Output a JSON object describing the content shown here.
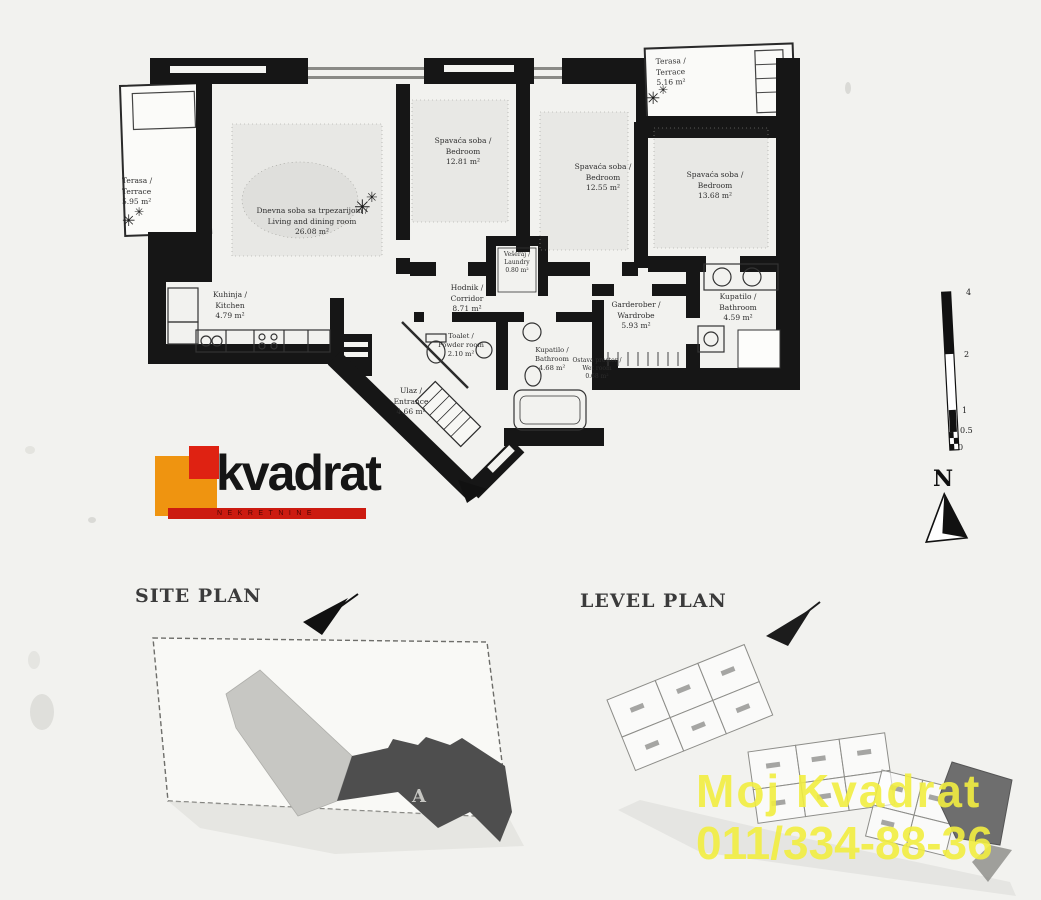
{
  "page": {
    "background_color": "#f2f2ef"
  },
  "logo": {
    "name": "kvadrat",
    "subtitle": "NEKRETNINE",
    "orange_color": "#ef9410",
    "red_color": "#df2212",
    "bar_color": "#cc1b10"
  },
  "floor_plan": {
    "north_label": "N",
    "rooms": [
      {
        "id": "terrace-left",
        "line1": "Terasa /",
        "line2": "Terrace",
        "line3": "5.95 m²"
      },
      {
        "id": "living-dining",
        "line1": "Dnevna soba sa trpezarijom /",
        "line2": "Living and dining room",
        "line3": "26.08 m²"
      },
      {
        "id": "bedroom-1",
        "line1": "Spavaća soba /",
        "line2": "Bedroom",
        "line3": "12.81 m²"
      },
      {
        "id": "bedroom-2",
        "line1": "Spavaća soba /",
        "line2": "Bedroom",
        "line3": "12.55 m²"
      },
      {
        "id": "bedroom-3",
        "line1": "Spavaća soba /",
        "line2": "Bedroom",
        "line3": "13.68 m²"
      },
      {
        "id": "terrace-top",
        "line1": "Terasa /",
        "line2": "Terrace",
        "line3": "5.16 m²"
      },
      {
        "id": "kitchen",
        "line1": "Kuhinja /",
        "line2": "Kitchen",
        "line3": "4.79 m²"
      },
      {
        "id": "corridor",
        "line1": "Hodnik /",
        "line2": "Corridor",
        "line3": "8.71 m²"
      },
      {
        "id": "laundry",
        "line1": "Vešeraj /",
        "line2": "Laundry",
        "line3": "0.80 m²"
      },
      {
        "id": "toilet",
        "line1": "Toalet /",
        "line2": "Powder room",
        "line3": "2.10 m²"
      },
      {
        "id": "bathroom-1",
        "line1": "Kupatilo /",
        "line2": "Bathroom",
        "line3": "4.68 m²"
      },
      {
        "id": "wardrobe",
        "line1": "Garderober /",
        "line2": "Wardrobe",
        "line3": "5.93 m²"
      },
      {
        "id": "bathroom-2",
        "line1": "Kupatilo /",
        "line2": "Bathroom",
        "line3": "4.59 m²"
      },
      {
        "id": "wet-room",
        "line1": "Ostava prostor /",
        "line2": "Wet room",
        "line3": "0.68 m²"
      },
      {
        "id": "entrance",
        "line1": "Ulaz /",
        "line2": "Entrance",
        "line3": "4.66 m²"
      }
    ],
    "scale_bar": {
      "labels": [
        "4",
        "2",
        "1",
        "0.5",
        "0"
      ]
    }
  },
  "site_plan": {
    "title": "SITE PLAN",
    "building_label": "A"
  },
  "level_plan": {
    "title": "LEVEL PLAN"
  },
  "watermark": {
    "line1": "Moj Kvadrat",
    "line2": "011/334-88-36",
    "color": "#f2ee41"
  }
}
